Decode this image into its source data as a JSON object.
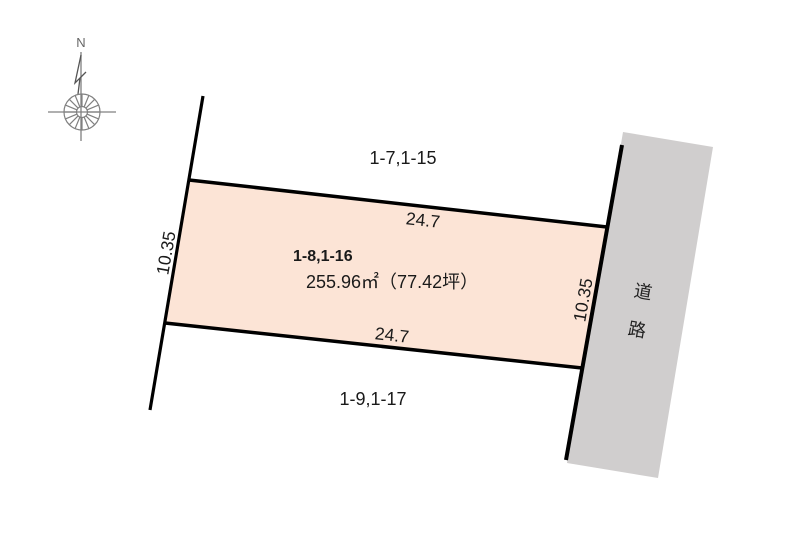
{
  "compass": {
    "north_label": "N"
  },
  "parcel": {
    "id": "1-8,1-16",
    "area": "255.96㎡（77.42坪）",
    "dimensions": {
      "top_width": "24.7",
      "bottom_width": "24.7",
      "left_depth": "10.35",
      "right_depth": "10.35"
    }
  },
  "neighbors": {
    "north": "1-7,1-15",
    "south": "1-9,1-17"
  },
  "road": {
    "label": "道路",
    "chars": [
      "道",
      "路"
    ]
  },
  "colors": {
    "parcel_fill": "#fce4d6",
    "road_fill": "#d0cece",
    "boundary_line": "#000000",
    "compass_gray": "#808080"
  }
}
